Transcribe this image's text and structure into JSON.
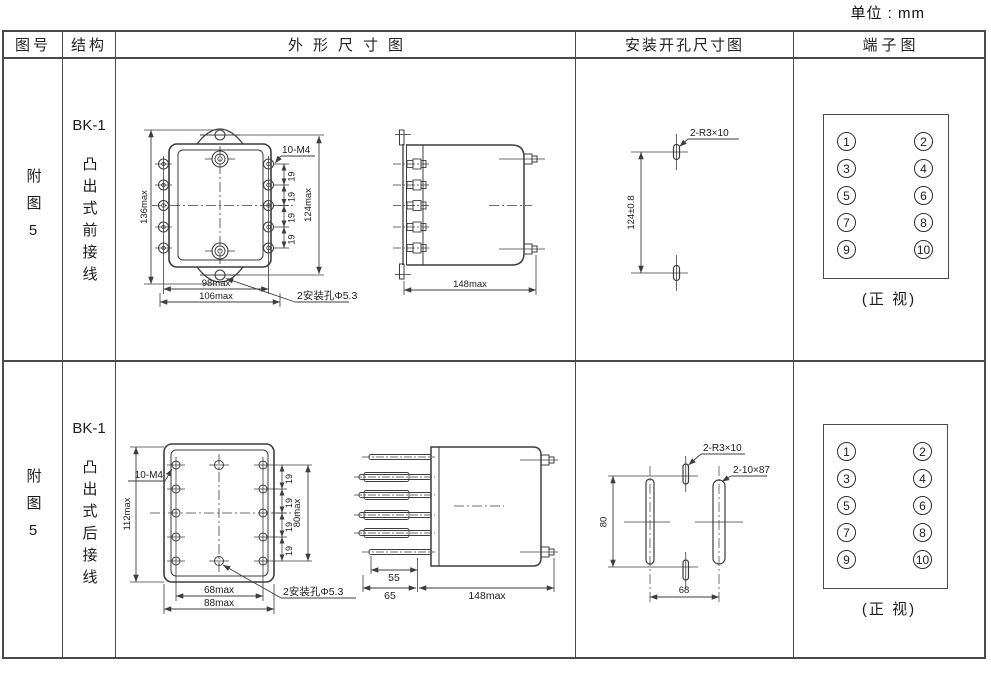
{
  "units_label": "单位 : mm",
  "header": {
    "fig_no": "图号",
    "structure": "结构",
    "outline": "外形尺寸图",
    "mounting": "安装开孔尺寸图",
    "terminal": "端子图"
  },
  "rows": [
    {
      "fig_no": "附图5",
      "model": "BK-1",
      "structure": "凸出式前接线",
      "outline": {
        "height_total": "136max",
        "thread_note": "10-M4",
        "pitch": "19",
        "height_mount": "124max",
        "width_terminals": "98max",
        "width_total": "106max",
        "mount_hole_note": "2安装孔Φ5.3",
        "depth": "148max"
      },
      "mounting": {
        "slot_note": "2-R3×10",
        "hole_spacing": "124±0.8"
      },
      "terminal": {
        "numbers": [
          "1",
          "2",
          "3",
          "4",
          "5",
          "6",
          "7",
          "8",
          "9",
          "10"
        ],
        "caption": "(正 视)"
      }
    },
    {
      "fig_no": "附图5",
      "model": "BK-1",
      "structure": "凸出式后接线",
      "outline": {
        "height_total": "112max",
        "thread_note": "10-M4",
        "pitch": "19",
        "height_terminals": "80max",
        "width_terminals": "68max",
        "width_total": "88max",
        "mount_hole_note": "2安装孔Φ5.3",
        "pin_len_1": "55",
        "pin_len_2": "65",
        "depth": "148max"
      },
      "mounting": {
        "slot_note": "2-R3×10",
        "slot_note2": "2-10×87",
        "hole_spacing_v": "80",
        "hole_spacing_h": "68"
      },
      "terminal": {
        "numbers": [
          "1",
          "2",
          "3",
          "4",
          "5",
          "6",
          "7",
          "8",
          "9",
          "10"
        ],
        "caption": "(正 视)"
      }
    }
  ]
}
